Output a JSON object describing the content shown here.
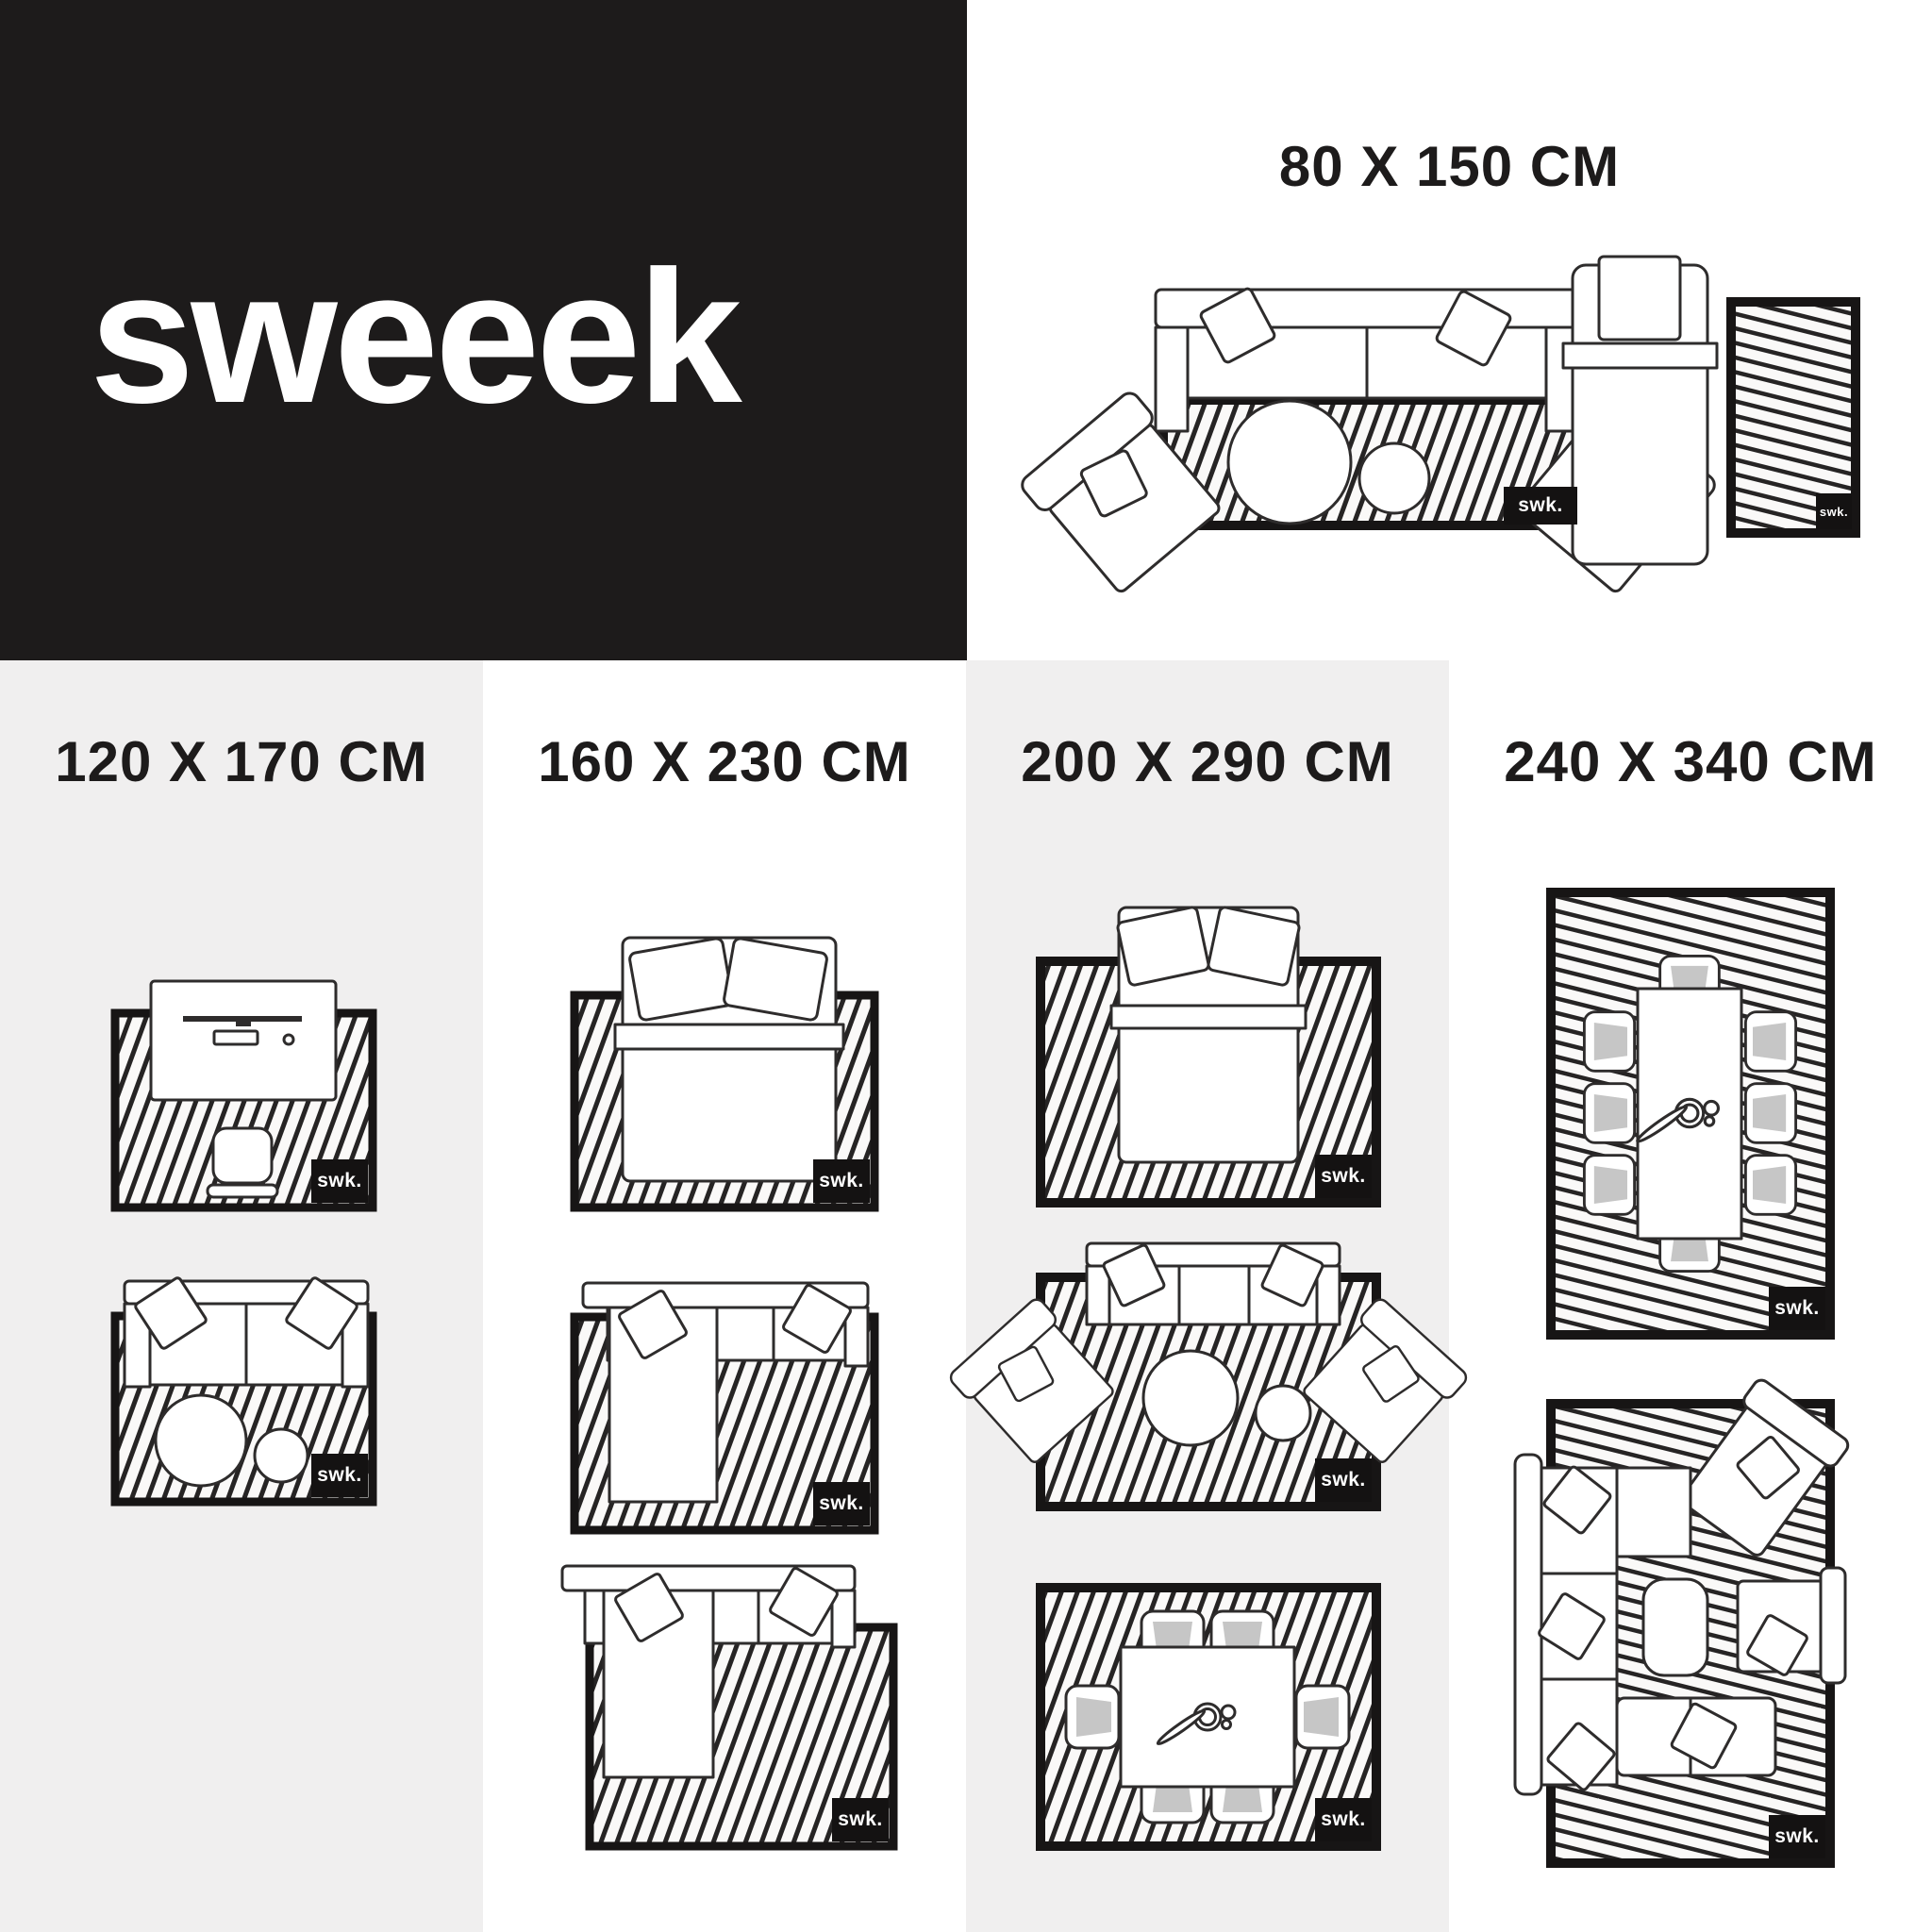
{
  "brand": {
    "logo_text": "sweeek",
    "badge_text": "swk."
  },
  "sections": {
    "s80": {
      "title": "80 X 150 CM"
    },
    "s120": {
      "title": "120 X 170 CM"
    },
    "s160": {
      "title": "160 X 230 CM"
    },
    "s200": {
      "title": "200 X 290 CM"
    },
    "s240": {
      "title": "240 X 340 CM"
    }
  },
  "diagrams": [
    {
      "size": "80 X 150 CM",
      "scenes": [
        "sofa with two angled armchairs and round coffee tables",
        "single bed with bedside runner rug"
      ]
    },
    {
      "size": "120 X 170 CM",
      "scenes": [
        "desk with monitor, keyboard, mouse and chair",
        "sofa with two round coffee tables"
      ]
    },
    {
      "size": "160 X 230 CM",
      "scenes": [
        "double bed with two pillows",
        "corner sofa with short chaise",
        "corner sofa with long chaise offset rug"
      ]
    },
    {
      "size": "200 X 290 CM",
      "scenes": [
        "double bed with two pillows",
        "sofa with two angled armchairs and round coffee tables",
        "dining table with 6 chairs"
      ]
    },
    {
      "size": "240 X 340 CM",
      "scenes": [
        "dining table with 8 chairs",
        "large corner sofa with lounge chair and armchair"
      ]
    }
  ],
  "colors": {
    "panel": "#1d1b1b",
    "column_alt": "#f0efef",
    "chair_fill": "#c6c6c6",
    "ink": "#2e2c2c"
  }
}
